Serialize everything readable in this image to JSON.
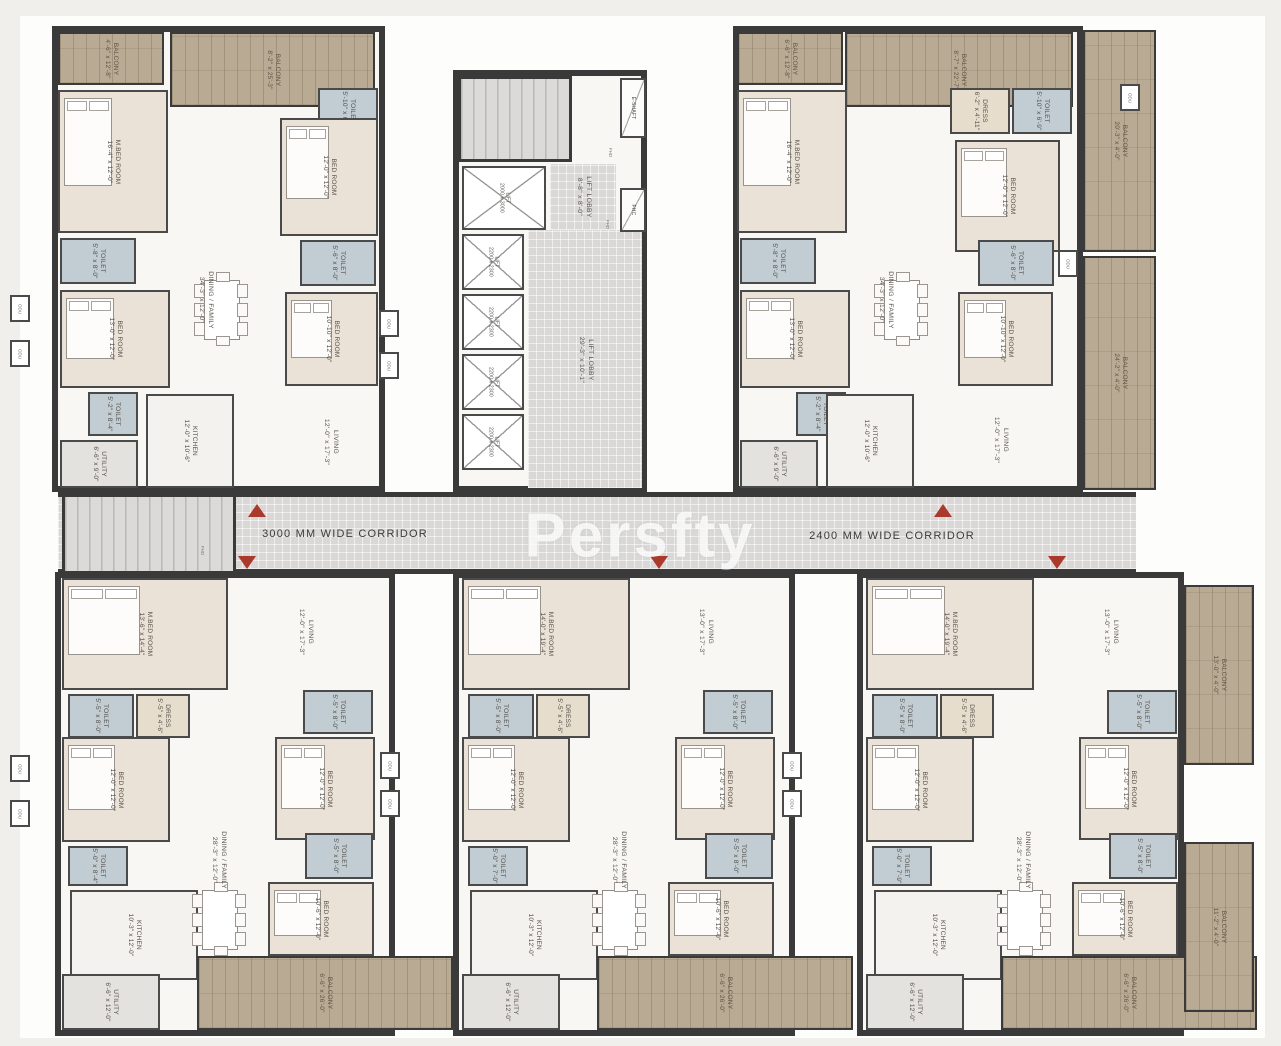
{
  "watermark": "Persfty",
  "corridor": {
    "label_left": "3000 MM WIDE CORRIDOR",
    "label_right": "2400 MM WIDE CORRIDOR"
  },
  "colors": {
    "wall": "#3a3a3a",
    "balcony_wood": "#b9aa93",
    "bedroom": "#eae2d6",
    "toilet": "#c2cdd3",
    "corridor_tile": "#d9d8d6",
    "entry_marker_red": "#a93a2c",
    "marble": "#f8f7f4"
  },
  "odu_label": "ODU",
  "fhd_label": "FHD",
  "units": [
    {
      "name": "unit-top-left",
      "x": 52,
      "y": 26,
      "w": 333,
      "h": 466
    },
    {
      "name": "unit-top-right",
      "x": 733,
      "y": 26,
      "w": 350,
      "h": 466
    },
    {
      "name": "core",
      "x": 453,
      "y": 70,
      "w": 194,
      "h": 422
    },
    {
      "name": "unit-bottom-left",
      "x": 55,
      "y": 572,
      "w": 340,
      "h": 464
    },
    {
      "name": "unit-bottom-mid",
      "x": 453,
      "y": 572,
      "w": 342,
      "h": 464
    },
    {
      "name": "unit-bottom-right",
      "x": 857,
      "y": 572,
      "w": 327,
      "h": 464
    }
  ],
  "zones": [
    {
      "name": "lift-lobby-small",
      "x": 550,
      "y": 164,
      "w": 66,
      "h": 66
    },
    {
      "name": "lift-lobby-main",
      "x": 528,
      "y": 230,
      "w": 114,
      "h": 258
    }
  ],
  "corridor_rect": {
    "x": 58,
    "y": 492,
    "w": 1078,
    "h": 82
  },
  "stairs": [
    {
      "name": "stair-core",
      "x": 458,
      "y": 76,
      "w": 114,
      "h": 86
    },
    {
      "name": "stair-west",
      "x": 62,
      "y": 494,
      "w": 174,
      "h": 80
    }
  ],
  "rooms": [
    {
      "unit": "TL",
      "name": "BALCONY",
      "dim": "4'-6\" x 12'-8\"",
      "type": "balcony",
      "x": 58,
      "y": 32,
      "w": 106,
      "h": 53
    },
    {
      "unit": "TL",
      "name": "BALCONY",
      "dim": "8'-2\" x 25'-3\"",
      "type": "balcony",
      "x": 170,
      "y": 32,
      "w": 205,
      "h": 75
    },
    {
      "unit": "TL",
      "name": "M.BED ROOM",
      "dim": "16'-4\" x 12'-0\"",
      "type": "bed",
      "x": 58,
      "y": 90,
      "w": 110,
      "h": 143
    },
    {
      "unit": "TL",
      "name": "TOILET",
      "dim": "5'-8\" x 8'-0\"",
      "type": "toilet",
      "x": 60,
      "y": 238,
      "w": 76,
      "h": 46
    },
    {
      "unit": "TL",
      "name": "BED ROOM",
      "dim": "13'-0\" x 12'-0\"",
      "type": "bed",
      "x": 60,
      "y": 290,
      "w": 110,
      "h": 98
    },
    {
      "unit": "TL",
      "name": "TOILET",
      "dim": "5'-2\" x 8'-4\"",
      "type": "toilet",
      "x": 88,
      "y": 392,
      "w": 50,
      "h": 44
    },
    {
      "unit": "TL",
      "name": "UTILITY",
      "dim": "6'-6\" x 9'-0\"",
      "type": "utility",
      "x": 60,
      "y": 440,
      "w": 78,
      "h": 48
    },
    {
      "unit": "TL",
      "name": "KITCHEN",
      "dim": "12'-0\" x 10'-6\"",
      "type": "kitchen",
      "x": 146,
      "y": 394,
      "w": 88,
      "h": 94
    },
    {
      "unit": "TL",
      "name": "DINING / FAMILY",
      "dim": "34'-3\" x 12'-0\"",
      "type": "label",
      "x": 205,
      "y": 300
    },
    {
      "unit": "TL",
      "name": "TOILET",
      "dim": "5'-10\" x 6'-9\"",
      "type": "toilet",
      "x": 318,
      "y": 88,
      "w": 60,
      "h": 46
    },
    {
      "unit": "TL",
      "name": "BED ROOM",
      "dim": "12'-0\" x 12'-0\"",
      "type": "bed",
      "x": 280,
      "y": 118,
      "w": 98,
      "h": 118
    },
    {
      "unit": "TL",
      "name": "TOILET",
      "dim": "5'-6\" x 8'-0\"",
      "type": "toilet",
      "x": 300,
      "y": 240,
      "w": 76,
      "h": 46
    },
    {
      "unit": "TL",
      "name": "BED ROOM",
      "dim": "10'-10\" x 12'-0\"",
      "type": "bed",
      "x": 285,
      "y": 292,
      "w": 93,
      "h": 94
    },
    {
      "unit": "TL",
      "name": "LIVING",
      "dim": "12'-0\" x 17'-3\"",
      "type": "label",
      "x": 330,
      "y": 442
    },
    {
      "unit": "TR",
      "name": "BALCONY",
      "dim": "6'-6\" x 12'-8\"",
      "type": "balcony",
      "x": 737,
      "y": 32,
      "w": 106,
      "h": 53
    },
    {
      "unit": "TR",
      "name": "BALCONY",
      "dim": "8'-7\" x 22'-7\"",
      "type": "balcony",
      "x": 845,
      "y": 32,
      "w": 228,
      "h": 75
    },
    {
      "unit": "TR",
      "name": "M.BED ROOM",
      "dim": "16'-4\" x 12'-0\"",
      "type": "bed",
      "x": 737,
      "y": 90,
      "w": 110,
      "h": 143
    },
    {
      "unit": "TR",
      "name": "DRESS",
      "dim": "6'-2\" x 4'-11\"",
      "type": "dress",
      "x": 950,
      "y": 88,
      "w": 60,
      "h": 46
    },
    {
      "unit": "TR",
      "name": "TOILET",
      "dim": "5'-10\" x 6'-9\"",
      "type": "toilet",
      "x": 1012,
      "y": 88,
      "w": 60,
      "h": 46
    },
    {
      "unit": "TR",
      "name": "BED ROOM",
      "dim": "12'-0\" x 12'-0\"",
      "type": "bed",
      "x": 955,
      "y": 140,
      "w": 105,
      "h": 112
    },
    {
      "unit": "TR",
      "name": "BALCONY",
      "dim": "20'-3\" x 4'-0\"",
      "type": "balcony",
      "x": 1083,
      "y": 30,
      "w": 73,
      "h": 222
    },
    {
      "unit": "TR",
      "name": "TOILET",
      "dim": "5'-8\" x 8'-0\"",
      "type": "toilet",
      "x": 740,
      "y": 238,
      "w": 76,
      "h": 46
    },
    {
      "unit": "TR",
      "name": "BED ROOM",
      "dim": "13'-0\" x 12'-0\"",
      "type": "bed",
      "x": 740,
      "y": 290,
      "w": 110,
      "h": 98
    },
    {
      "unit": "TR",
      "name": "TOILET",
      "dim": "5'-2\" x 8'-4\"",
      "type": "toilet",
      "x": 796,
      "y": 392,
      "w": 50,
      "h": 44
    },
    {
      "unit": "TR",
      "name": "UTILITY",
      "dim": "6'-6\" x 9'-0\"",
      "type": "utility",
      "x": 740,
      "y": 440,
      "w": 78,
      "h": 48
    },
    {
      "unit": "TR",
      "name": "KITCHEN",
      "dim": "12'-0\" x 10'-6\"",
      "type": "kitchen",
      "x": 826,
      "y": 394,
      "w": 88,
      "h": 94
    },
    {
      "unit": "TR",
      "name": "DINING / FAMILY",
      "dim": "34'-3\" x 12'-0\"",
      "type": "label",
      "x": 885,
      "y": 300
    },
    {
      "unit": "TR",
      "name": "TOILET",
      "dim": "5'-6\" x 8'-0\"",
      "type": "toilet",
      "x": 978,
      "y": 240,
      "w": 76,
      "h": 46
    },
    {
      "unit": "TR",
      "name": "BED ROOM",
      "dim": "10'-10\" x 12'-0\"",
      "type": "bed",
      "x": 958,
      "y": 292,
      "w": 95,
      "h": 94
    },
    {
      "unit": "TR",
      "name": "LIVING",
      "dim": "12'-0\" x 17'-3\"",
      "type": "label",
      "x": 1000,
      "y": 440
    },
    {
      "unit": "TR",
      "name": "BALCONY",
      "dim": "24'-2\" x 4'-0\"",
      "type": "balcony",
      "x": 1083,
      "y": 256,
      "w": 73,
      "h": 234
    },
    {
      "unit": "CORE",
      "name": "LIFT",
      "dim": "2000 x 3000",
      "type": "lift",
      "x": 462,
      "y": 166,
      "w": 84,
      "h": 64
    },
    {
      "unit": "CORE",
      "name": "LIFT LOBBY",
      "dim": "8'-8\" x 8'-0\"",
      "type": "label",
      "x": 583,
      "y": 197
    },
    {
      "unit": "CORE",
      "name": "LIFT",
      "dim": "2200 x 2300",
      "type": "lift",
      "x": 462,
      "y": 234,
      "w": 62,
      "h": 56
    },
    {
      "unit": "CORE",
      "name": "LIFT",
      "dim": "2200 x 2300",
      "type": "lift",
      "x": 462,
      "y": 294,
      "w": 62,
      "h": 56
    },
    {
      "unit": "CORE",
      "name": "LIFT",
      "dim": "2200 x 2300",
      "type": "lift",
      "x": 462,
      "y": 354,
      "w": 62,
      "h": 56
    },
    {
      "unit": "CORE",
      "name": "LIFT",
      "dim": "2200 x 2300",
      "type": "lift",
      "x": 462,
      "y": 414,
      "w": 62,
      "h": 56
    },
    {
      "unit": "CORE",
      "name": "LIFT LOBBY",
      "dim": "29'-3\" x 10'-1\"",
      "type": "label",
      "x": 585,
      "y": 360
    },
    {
      "unit": "CORE",
      "name": "E-SHAFT",
      "dim": "",
      "type": "shaft",
      "x": 620,
      "y": 78,
      "w": 26,
      "h": 60
    },
    {
      "unit": "CORE",
      "name": "FHC",
      "dim": "",
      "type": "shaft",
      "x": 620,
      "y": 188,
      "w": 26,
      "h": 44
    },
    {
      "unit": "BL",
      "name": "M.BED ROOM",
      "dim": "13'-6\" x 14'-4\"",
      "type": "bed",
      "x": 62,
      "y": 578,
      "w": 166,
      "h": 112
    },
    {
      "unit": "BL",
      "name": "TOILET",
      "dim": "5'-5\" x 8'-0\"",
      "type": "toilet",
      "x": 68,
      "y": 694,
      "w": 66,
      "h": 44
    },
    {
      "unit": "BL",
      "name": "DRESS",
      "dim": "5'-5\" x 4'-6\"",
      "type": "dress",
      "x": 136,
      "y": 694,
      "w": 54,
      "h": 44
    },
    {
      "unit": "BL",
      "name": "LIVING",
      "dim": "12'-0\" x 17'-3\"",
      "type": "label",
      "x": 305,
      "y": 632
    },
    {
      "unit": "BL",
      "name": "TOILET",
      "dim": "5'-5\" x 8'-0\"",
      "type": "toilet",
      "x": 303,
      "y": 690,
      "w": 70,
      "h": 44
    },
    {
      "unit": "BL",
      "name": "BED ROOM",
      "dim": "12'-0\" x 12'-0\"",
      "type": "bed",
      "x": 275,
      "y": 737,
      "w": 100,
      "h": 103
    },
    {
      "unit": "BL",
      "name": "BED ROOM",
      "dim": "12'-0\" x 12'-0\"",
      "type": "bed",
      "x": 62,
      "y": 737,
      "w": 108,
      "h": 105
    },
    {
      "unit": "BL",
      "name": "TOILET",
      "dim": "5'-0\" x 8'-4\"",
      "type": "toilet",
      "x": 68,
      "y": 846,
      "w": 60,
      "h": 40
    },
    {
      "unit": "BL",
      "name": "DINING / FAMILY",
      "dim": "28'-3\" x 12'-0\"",
      "type": "label",
      "x": 218,
      "y": 860
    },
    {
      "unit": "BL",
      "name": "KITCHEN",
      "dim": "10'-3\" x 12'-0\"",
      "type": "kitchen",
      "x": 70,
      "y": 890,
      "w": 128,
      "h": 90
    },
    {
      "unit": "BL",
      "name": "UTILITY",
      "dim": "6'-6\" x 12'-0\"",
      "type": "utility",
      "x": 62,
      "y": 974,
      "w": 98,
      "h": 56
    },
    {
      "unit": "BL",
      "name": "TOILET",
      "dim": "5'-5\" x 8'-0\"",
      "type": "toilet",
      "x": 305,
      "y": 833,
      "w": 68,
      "h": 46
    },
    {
      "unit": "BL",
      "name": "BED ROOM",
      "dim": "10'-6\" x 12'-0\"",
      "type": "bed",
      "x": 268,
      "y": 882,
      "w": 106,
      "h": 74
    },
    {
      "unit": "BL",
      "name": "BALCONY",
      "dim": "6'-6\" x 26'-0\"",
      "type": "balcony",
      "x": 197,
      "y": 956,
      "w": 256,
      "h": 74
    },
    {
      "unit": "BM",
      "name": "M.BED ROOM",
      "dim": "14'-0\" x 19'-4\"",
      "type": "bed",
      "x": 462,
      "y": 578,
      "w": 168,
      "h": 112
    },
    {
      "unit": "BM",
      "name": "TOILET",
      "dim": "5'-5\" x 8'-0\"",
      "type": "toilet",
      "x": 468,
      "y": 694,
      "w": 66,
      "h": 44
    },
    {
      "unit": "BM",
      "name": "DRESS",
      "dim": "5'-5\" x 4'-6\"",
      "type": "dress",
      "x": 536,
      "y": 694,
      "w": 54,
      "h": 44
    },
    {
      "unit": "BM",
      "name": "LIVING",
      "dim": "13'-0\" x 17'-3\"",
      "type": "label",
      "x": 705,
      "y": 632
    },
    {
      "unit": "BM",
      "name": "TOILET",
      "dim": "5'-5\" x 8'-0\"",
      "type": "toilet",
      "x": 703,
      "y": 690,
      "w": 70,
      "h": 44
    },
    {
      "unit": "BM",
      "name": "BED ROOM",
      "dim": "12'-0\" x 12'-0\"",
      "type": "bed",
      "x": 675,
      "y": 737,
      "w": 100,
      "h": 103
    },
    {
      "unit": "BM",
      "name": "BED ROOM",
      "dim": "12'-0\" x 12'-0\"",
      "type": "bed",
      "x": 462,
      "y": 737,
      "w": 108,
      "h": 105
    },
    {
      "unit": "BM",
      "name": "TOILET",
      "dim": "5'-0\" x 7'-0\"",
      "type": "toilet",
      "x": 468,
      "y": 846,
      "w": 60,
      "h": 40
    },
    {
      "unit": "BM",
      "name": "DINING / FAMILY",
      "dim": "28'-3\" x 12'-0\"",
      "type": "label",
      "x": 618,
      "y": 860
    },
    {
      "unit": "BM",
      "name": "KITCHEN",
      "dim": "10'-3\" x 12'-0\"",
      "type": "kitchen",
      "x": 470,
      "y": 890,
      "w": 128,
      "h": 90
    },
    {
      "unit": "BM",
      "name": "UTILITY",
      "dim": "6'-6\" x 12'-0\"",
      "type": "utility",
      "x": 462,
      "y": 974,
      "w": 98,
      "h": 56
    },
    {
      "unit": "BM",
      "name": "TOILET",
      "dim": "5'-5\" x 8'-0\"",
      "type": "toilet",
      "x": 705,
      "y": 833,
      "w": 68,
      "h": 46
    },
    {
      "unit": "BM",
      "name": "BED ROOM",
      "dim": "10'-6\" x 12'-0\"",
      "type": "bed",
      "x": 668,
      "y": 882,
      "w": 106,
      "h": 74
    },
    {
      "unit": "BM",
      "name": "BALCONY",
      "dim": "6'-6\" x 26'-0\"",
      "type": "balcony",
      "x": 597,
      "y": 956,
      "w": 256,
      "h": 74
    },
    {
      "unit": "BR",
      "name": "M.BED ROOM",
      "dim": "14'-0\" x 19'-4\"",
      "type": "bed",
      "x": 866,
      "y": 578,
      "w": 168,
      "h": 112
    },
    {
      "unit": "BR",
      "name": "TOILET",
      "dim": "5'-5\" x 8'-0\"",
      "type": "toilet",
      "x": 872,
      "y": 694,
      "w": 66,
      "h": 44
    },
    {
      "unit": "BR",
      "name": "DRESS",
      "dim": "5'-5\" x 4'-6\"",
      "type": "dress",
      "x": 940,
      "y": 694,
      "w": 54,
      "h": 44
    },
    {
      "unit": "BR",
      "name": "LIVING",
      "dim": "13'-0\" x 17'-3\"",
      "type": "label",
      "x": 1110,
      "y": 632
    },
    {
      "unit": "BR",
      "name": "TOILET",
      "dim": "5'-5\" x 8'-0\"",
      "type": "toilet",
      "x": 1107,
      "y": 690,
      "w": 70,
      "h": 44
    },
    {
      "unit": "BR",
      "name": "BED ROOM",
      "dim": "12'-0\" x 12'-0\"",
      "type": "bed",
      "x": 1079,
      "y": 737,
      "w": 100,
      "h": 103
    },
    {
      "unit": "BR",
      "name": "BED ROOM",
      "dim": "12'-0\" x 12'-0\"",
      "type": "bed",
      "x": 866,
      "y": 737,
      "w": 108,
      "h": 105
    },
    {
      "unit": "BR",
      "name": "TOILET",
      "dim": "5'-0\" x 7'-9\"",
      "type": "toilet",
      "x": 872,
      "y": 846,
      "w": 60,
      "h": 40
    },
    {
      "unit": "BR",
      "name": "DINING / FAMILY",
      "dim": "28'-3\" x 12'-0\"",
      "type": "label",
      "x": 1022,
      "y": 860
    },
    {
      "unit": "BR",
      "name": "KITCHEN",
      "dim": "10'-3\" x 12'-0\"",
      "type": "kitchen",
      "x": 874,
      "y": 890,
      "w": 128,
      "h": 90
    },
    {
      "unit": "BR",
      "name": "UTILITY",
      "dim": "6'-6\" x 12'-0\"",
      "type": "utility",
      "x": 866,
      "y": 974,
      "w": 98,
      "h": 56
    },
    {
      "unit": "BR",
      "name": "TOILET",
      "dim": "5'-5\" x 8'-0\"",
      "type": "toilet",
      "x": 1109,
      "y": 833,
      "w": 68,
      "h": 46
    },
    {
      "unit": "BR",
      "name": "BED ROOM",
      "dim": "10'-6\" x 12'-0\"",
      "type": "bed",
      "x": 1072,
      "y": 882,
      "w": 106,
      "h": 74
    },
    {
      "unit": "BR",
      "name": "BALCONY",
      "dim": "6'-6\" x 26'-0\"",
      "type": "balcony",
      "x": 1001,
      "y": 956,
      "w": 256,
      "h": 74
    },
    {
      "unit": "BR",
      "name": "BALCONY",
      "dim": "13'-0\" x 4'-0\"",
      "type": "balcony",
      "x": 1184,
      "y": 585,
      "w": 70,
      "h": 180
    },
    {
      "unit": "BR",
      "name": "BALCONY",
      "dim": "11'-2\" x 4'-0\"",
      "type": "balcony",
      "x": 1184,
      "y": 842,
      "w": 70,
      "h": 170
    }
  ],
  "tables": [
    {
      "x": 192,
      "y": 272
    },
    {
      "x": 872,
      "y": 272
    },
    {
      "x": 190,
      "y": 882
    },
    {
      "x": 590,
      "y": 882
    },
    {
      "x": 995,
      "y": 882
    }
  ],
  "odu_boxes": [
    {
      "x": 10,
      "y": 295
    },
    {
      "x": 10,
      "y": 340
    },
    {
      "x": 10,
      "y": 755
    },
    {
      "x": 10,
      "y": 800
    },
    {
      "x": 379,
      "y": 310
    },
    {
      "x": 379,
      "y": 352
    },
    {
      "x": 380,
      "y": 752
    },
    {
      "x": 380,
      "y": 790
    },
    {
      "x": 782,
      "y": 752
    },
    {
      "x": 782,
      "y": 790
    },
    {
      "x": 1058,
      "y": 250
    },
    {
      "x": 1120,
      "y": 84
    }
  ],
  "triangles": [
    {
      "x": 248,
      "y": 504,
      "dir": "up"
    },
    {
      "x": 934,
      "y": 504,
      "dir": "up"
    },
    {
      "x": 238,
      "y": 556,
      "dir": "down"
    },
    {
      "x": 650,
      "y": 556,
      "dir": "down"
    },
    {
      "x": 1048,
      "y": 556,
      "dir": "down"
    }
  ],
  "fhd_marks": [
    {
      "x": 606,
      "y": 150
    },
    {
      "x": 603,
      "y": 222
    },
    {
      "x": 198,
      "y": 548
    }
  ]
}
